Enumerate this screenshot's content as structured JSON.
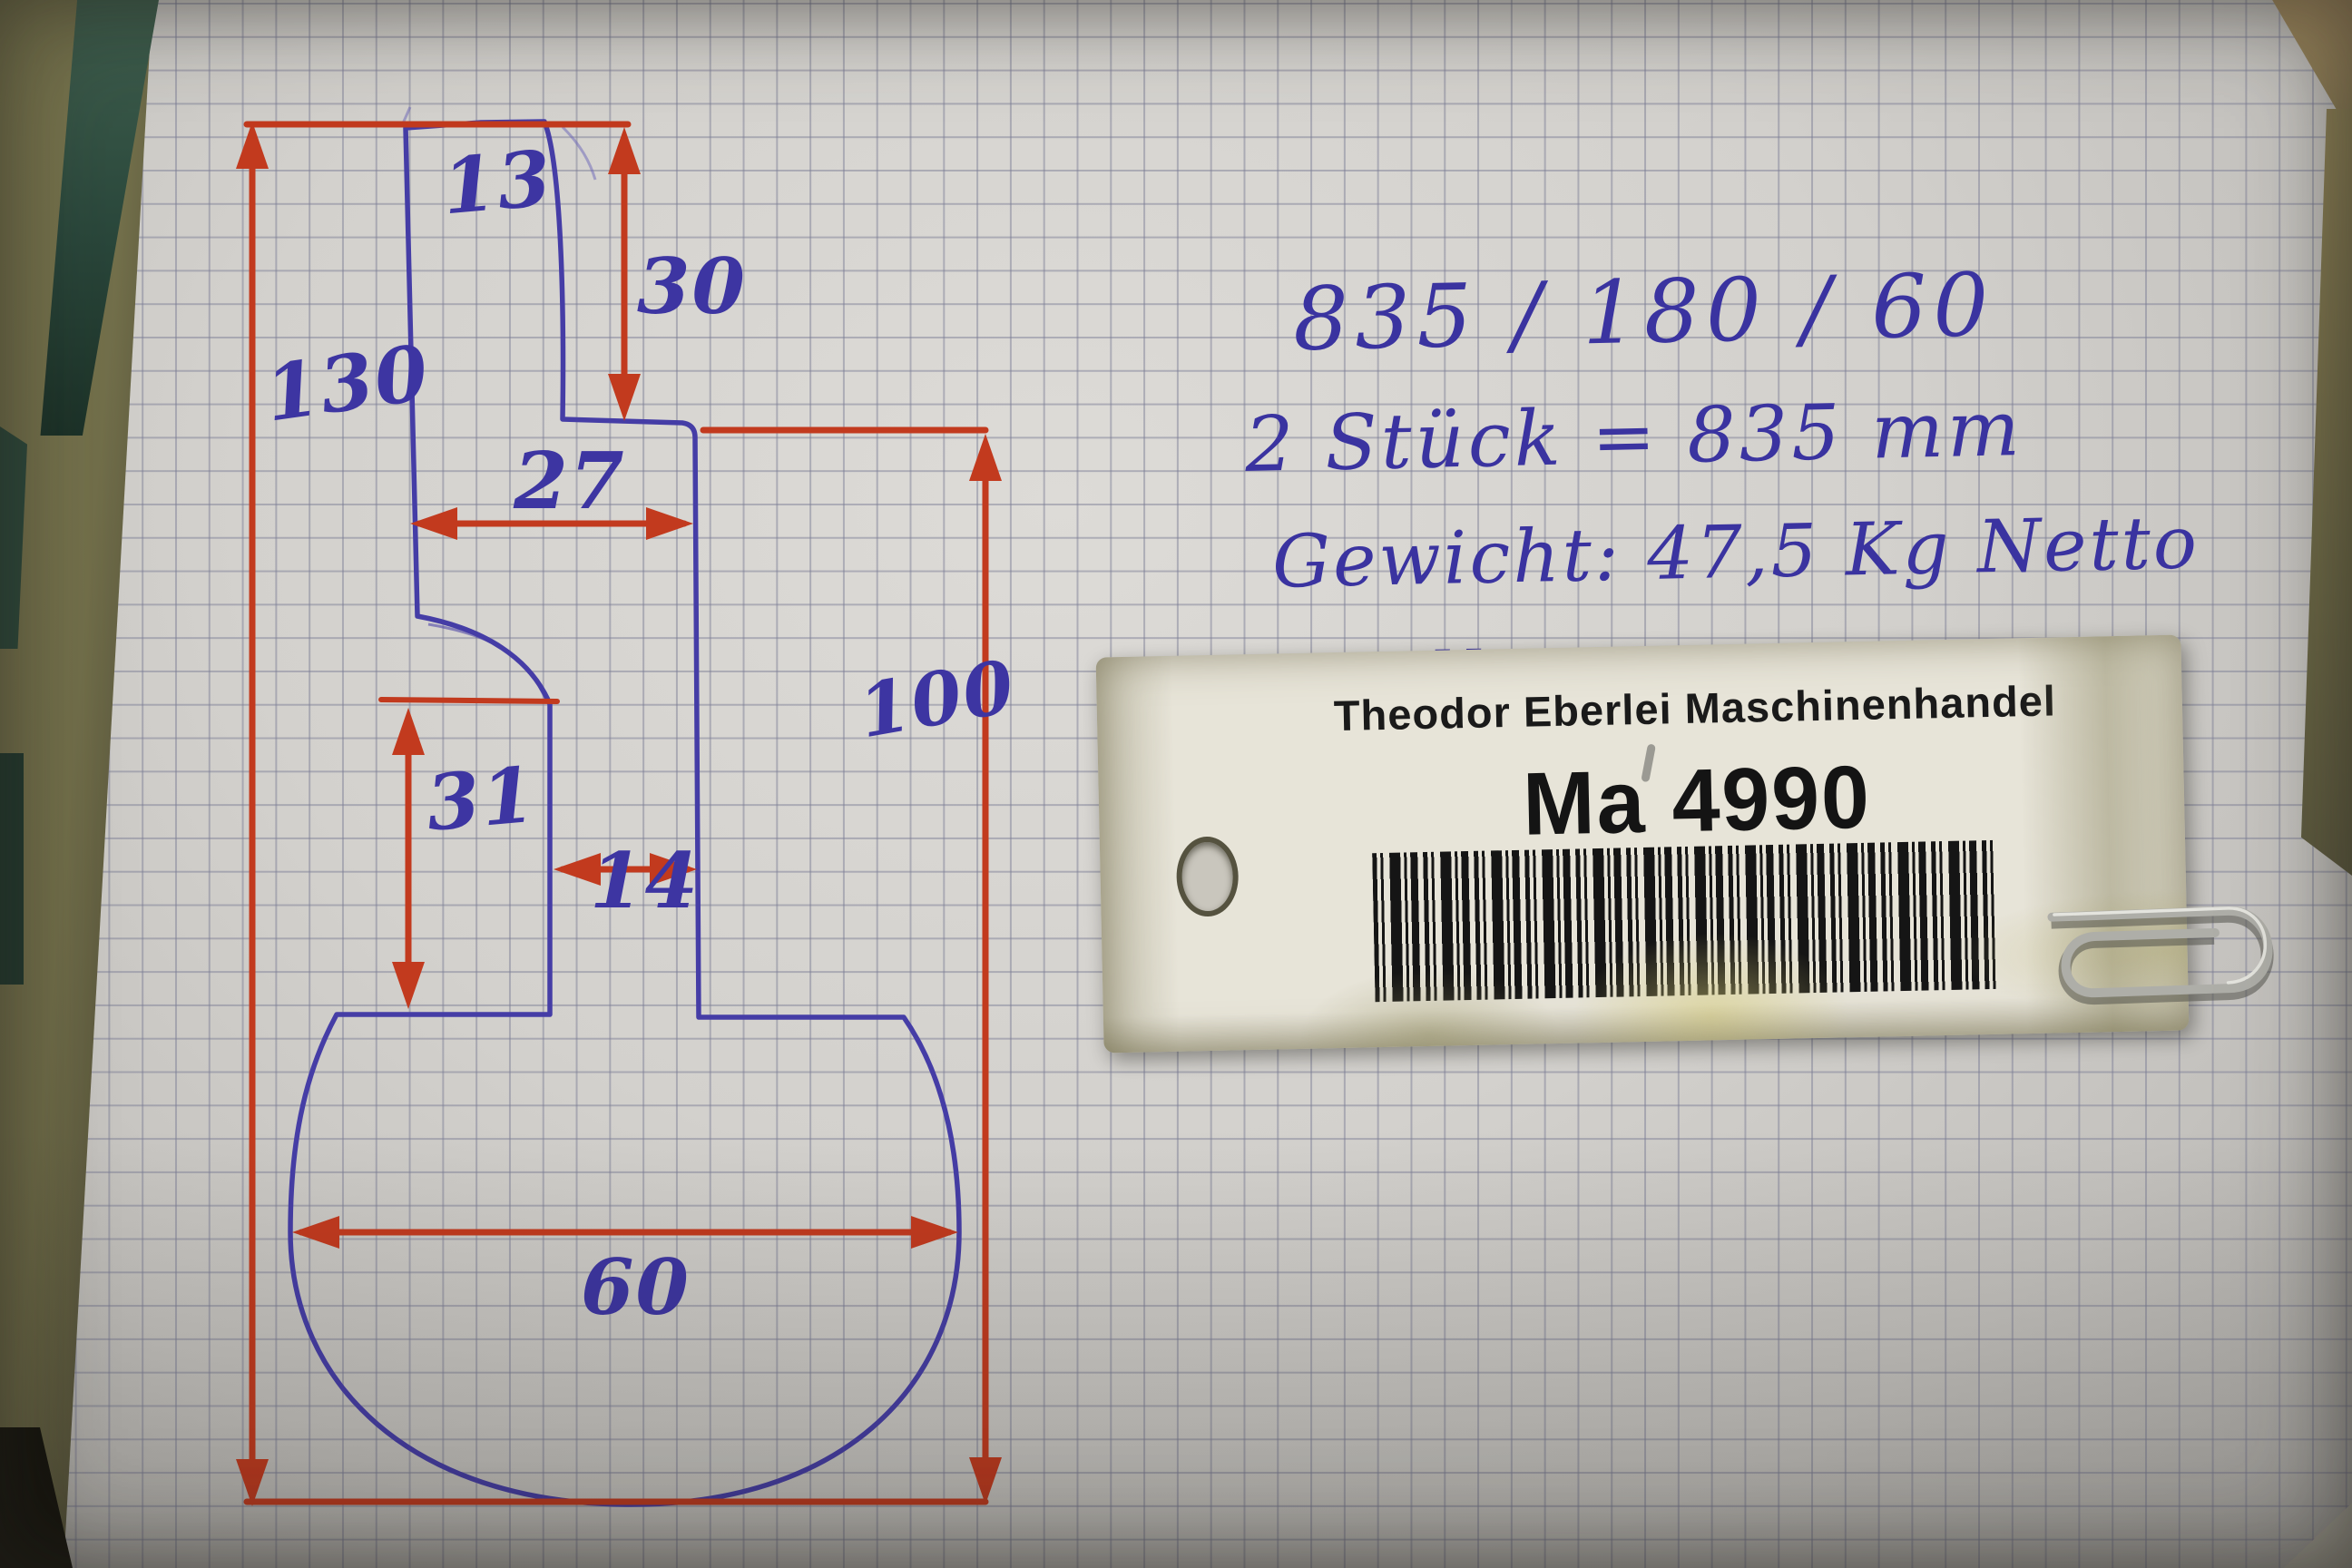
{
  "drawing": {
    "labels": {
      "d13": "13",
      "d30": "30",
      "d130": "130",
      "d27": "27",
      "d31": "31",
      "d14": "14",
      "d100": "100",
      "d60": "60"
    },
    "ink_colors": {
      "profile_blue": "#453da6",
      "dimension_red": "#c23a1e",
      "label_blue": "#3d35a2"
    }
  },
  "notes": {
    "line1": "835 / 180 / 60",
    "line2": "2 Stück = 835 mm",
    "line3": "Gewicht: 47,5 Kg Netto",
    "line4": "Halle 3",
    "ink_color": "#3a33a0"
  },
  "tag": {
    "company": "Theodor Eberlei Maschinenhandel",
    "tag_id": "Ma 4990",
    "barcode": "barcode",
    "background": "#e7e4d8",
    "text_color": "#1a1a1a"
  },
  "paper": {
    "base_color": "#d5d3cf",
    "grid_color": "#9b9aa4"
  },
  "table": {
    "olive": "#73704b",
    "teal": "#2c4a3d",
    "tan": "#a18758"
  }
}
